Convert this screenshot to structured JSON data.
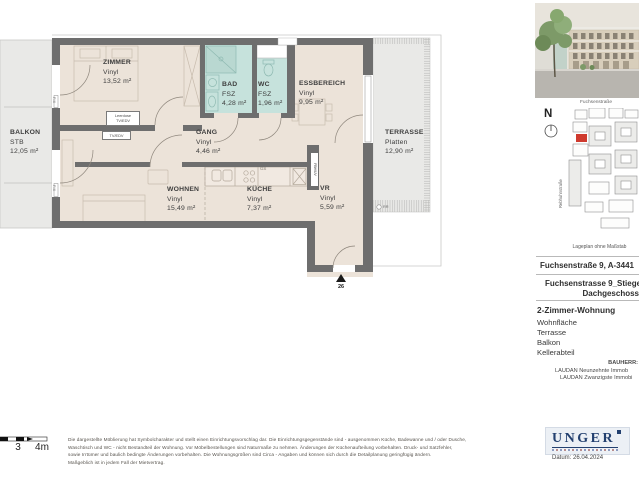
{
  "plan": {
    "rooms": {
      "zimmer": {
        "name": "ZIMMER",
        "floor": "Vinyl",
        "area": "13,52 m²"
      },
      "bad": {
        "name": "BAD",
        "floor": "FSZ",
        "area": "4,28 m²"
      },
      "wc": {
        "name": "WC",
        "floor": "FSZ",
        "area": "1,96 m²"
      },
      "essbereich": {
        "name": "ESSBEREICH",
        "floor": "Vinyl",
        "area": "9,95 m²"
      },
      "balkon": {
        "name": "BALKON",
        "floor": "STB",
        "area": "12,05 m²"
      },
      "gang": {
        "name": "GANG",
        "floor": "Vinyl",
        "area": "4,46 m²"
      },
      "wohnen": {
        "name": "WOHNEN",
        "floor": "Vinyl",
        "area": "15,49 m²"
      },
      "kueche": {
        "name": "KÜCHE",
        "floor": "Vinyl",
        "area": "7,37 m²"
      },
      "vr": {
        "name": "VR",
        "floor": "Vinyl",
        "area": "5,59 m²"
      },
      "terrasse": {
        "name": "TERRASSE",
        "floor": "Platten",
        "area": "12,90 m²"
      }
    },
    "annotations": {
      "leerdose_line1": "Leerdose",
      "leerdose_line2": "TV/EDV",
      "tv_edv": "TV/EDV",
      "fix": "FIX",
      "gs": "GS",
      "fbh_uv": "FBH/UV",
      "rr": "RR",
      "unit_number": "26"
    },
    "scalebar": {
      "label_3": "3",
      "label_4m": "4m"
    }
  },
  "sidebar": {
    "north_label": "N",
    "map": {
      "street_top": "Fuchsenstraße",
      "street_left": "Rebhuhnstraße",
      "caption": "Lageplan ohne Maßstab"
    },
    "address": "Fuchsenstraße 9, A-3441",
    "unit_line1": "Fuchsenstrasse 9_Stiege",
    "unit_line2": "Dachgeschoss",
    "apartment_type": "2-Zimmer-Wohnung",
    "features": [
      "Wohnfläche",
      "Terrasse",
      "Balkon",
      "Kellerabteil"
    ],
    "bauherr_label": "BAUHERR:",
    "bauherr_line1": "LAUDAN Neunzehnte Immob",
    "bauherr_line2": "LAUDAN Zwanzigste Immobi",
    "logo_text": "UNGER",
    "date": "Datum: 26.04.2024"
  },
  "footer": {
    "disclaimer_line1": "Die dargestellte Möblierung hat Symbolcharakter und stellt einen Einrichtungsvorschlag dar. Die Einrichtungsgegenstände sind - ausgenommen Küche, Badewanne und / oder Dusche,",
    "disclaimer_line2": "Waschtisch und WC - nicht Bestandteil der Wohnung. Vor Möbelbestellungen sind Naturmaße zu nehmen. Änderungen der Küchenaufteilung vorbehalten. Druck- und Satzfehler,",
    "disclaimer_line3": "sowie Irrtümer und baulich bedingte Änderungen vorbehalten. Die Wohnungsgrößen sind Circa - Angaben und können sich durch die Detailplanung geringfügig ändern.",
    "disclaimer_line4": "Maßgeblich ist in jedem Fall der Mietvertrag."
  },
  "colors": {
    "wall": "#6e6e6e",
    "room_floor": "#ece3d9",
    "outdoor_floor": "#e9e9e7",
    "wet_room_floor": "#c6e2dc",
    "unit_marker_red": "#cf3a2e",
    "logo_navy": "#23406f"
  }
}
